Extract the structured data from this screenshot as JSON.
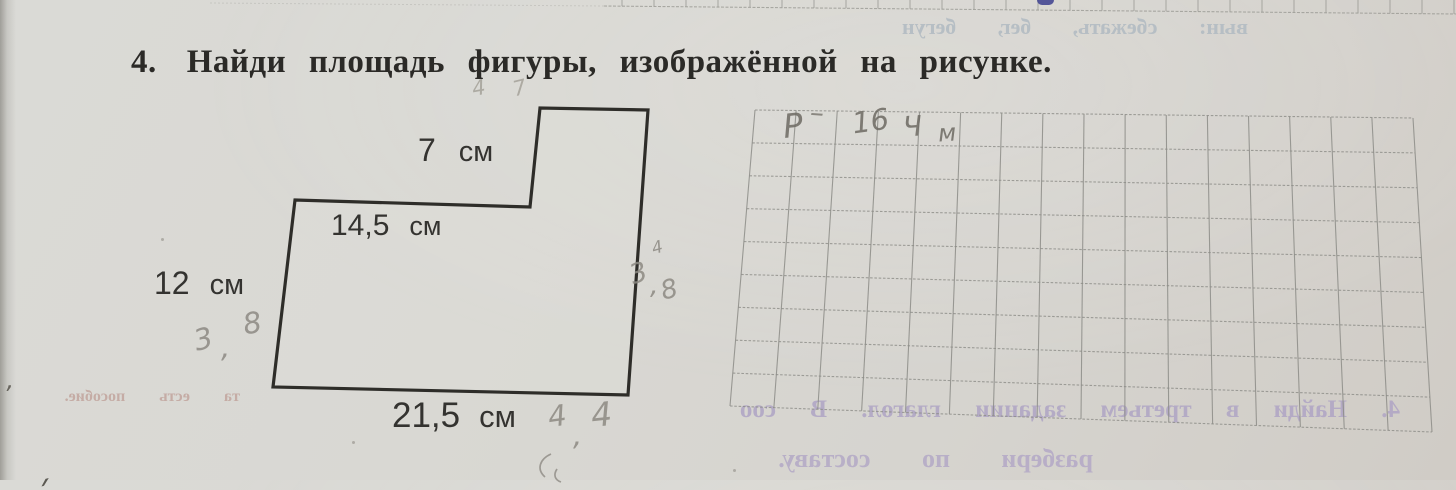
{
  "page": {
    "title_number": "4.",
    "title": "Найди площадь фигуры, изображённой на рисунке.",
    "paper_color": "#d8d6d1",
    "ink_color": "#2b2a27"
  },
  "figure": {
    "description": "L-shaped polygon with a rectangular step cut from the top-left",
    "stroke_color": "#2e2d29",
    "polygon_points": [
      [
        295,
        200
      ],
      [
        530,
        207
      ],
      [
        540,
        108
      ],
      [
        648,
        110
      ],
      [
        628,
        395
      ],
      [
        273,
        387
      ]
    ],
    "labels": {
      "top": {
        "value": "7",
        "unit": "см"
      },
      "step": {
        "value": "14,5",
        "unit": "см"
      },
      "left": {
        "value": "12",
        "unit": "см"
      },
      "bottom": {
        "value": "21,5",
        "unit": "см"
      }
    }
  },
  "answer_grid": {
    "cols": 16,
    "rows": 9,
    "line_color": "#8d8d88",
    "corners": {
      "tl": [
        755,
        110
      ],
      "tr": [
        1413,
        118
      ],
      "br": [
        1432,
        432
      ],
      "bl": [
        730,
        406
      ]
    }
  },
  "top_grid": {
    "line_color": "#9b9b95",
    "start_x": 604,
    "end_x": 1456,
    "tick_spacing": 32,
    "y_start": 6,
    "y_end": 14,
    "faint_from_x": 210
  },
  "pen_mark_color": "#3c3f8e",
  "pencil": {
    "color": "#8d8a83",
    "stroke_paths": [
      "M 551,454 C 540,459 536,469 545,477",
      "M 557,469 C 553,475 555,480 561,482"
    ],
    "items": [
      {
        "text": "4",
        "x": 472,
        "y": 76,
        "size": 21,
        "rot": -10,
        "color": "#a5a29a"
      },
      {
        "text": "7",
        "x": 513,
        "y": 76,
        "size": 21,
        "rot": -14,
        "color": "#a5a29a"
      },
      {
        "text": "Р",
        "x": 783,
        "y": 106,
        "size": 33,
        "rot": -6,
        "color": "#6d6a63"
      },
      {
        "text": "–",
        "x": 810,
        "y": 96,
        "size": 28,
        "rot": 4,
        "color": "#7d7a73"
      },
      {
        "text": "16",
        "x": 852,
        "y": 104,
        "size": 29,
        "rot": -8,
        "color": "#6d6a63"
      },
      {
        "text": "Ч",
        "x": 903,
        "y": 110,
        "size": 28,
        "rot": -4,
        "color": "#6d6a63"
      },
      {
        "text": "м",
        "x": 938,
        "y": 119,
        "size": 24,
        "rot": -4,
        "color": "#6d6a63"
      },
      {
        "text": "4",
        "x": 652,
        "y": 238,
        "size": 17,
        "rot": -15
      },
      {
        "text": "3",
        "x": 630,
        "y": 258,
        "size": 27,
        "rot": -18
      },
      {
        "text": ",",
        "x": 650,
        "y": 270,
        "size": 27,
        "rot": 0
      },
      {
        "text": "8",
        "x": 661,
        "y": 275,
        "size": 26,
        "rot": -15
      },
      {
        "text": "3",
        "x": 194,
        "y": 322,
        "size": 29,
        "rot": -14
      },
      {
        "text": ",",
        "x": 221,
        "y": 330,
        "size": 29,
        "rot": 0
      },
      {
        "text": "8",
        "x": 243,
        "y": 306,
        "size": 29,
        "rot": -10
      },
      {
        "text": "4",
        "x": 548,
        "y": 399,
        "size": 29,
        "rot": -8
      },
      {
        "text": ",",
        "x": 573,
        "y": 418,
        "size": 29,
        "rot": 0
      },
      {
        "text": "4",
        "x": 591,
        "y": 395,
        "size": 33,
        "rot": -6
      },
      {
        "text": "ʼ",
        "x": 5,
        "y": 381,
        "size": 24,
        "rot": 0,
        "color": "#57544c"
      },
      {
        "text": "ˏ",
        "x": 28,
        "y": 448,
        "size": 34,
        "rot": -15,
        "color": "#46433c"
      }
    ]
  },
  "showthrough": {
    "note": "mirrored ink showing through from the reverse side of the page",
    "items": [
      {
        "text": "вын:  сбежать,  бег,  бегун",
        "x": 838,
        "y": 14,
        "w": 410,
        "size": 22,
        "ws": 36,
        "color": "#b3bcc3",
        "weight": 700
      },
      {
        "text": "та  есть  пособие.",
        "x": 50,
        "y": 388,
        "w": 190,
        "size": 16,
        "ws": 30,
        "color": "#c3a8a0",
        "weight": 700
      },
      {
        "text": "4. Найди в третьем задании глагол. В соо",
        "x": 628,
        "y": 396,
        "w": 772,
        "size": 25,
        "ws": 28,
        "color": "#b1a7c5",
        "weight": 700
      },
      {
        "text": "разбери  по  составу.",
        "x": 703,
        "y": 444,
        "w": 390,
        "size": 26,
        "ws": 45,
        "color": "#b5abc7",
        "weight": 700
      }
    ]
  },
  "specks": [
    [
      161,
      238
    ],
    [
      352,
      441
    ],
    [
      733,
      469
    ]
  ]
}
